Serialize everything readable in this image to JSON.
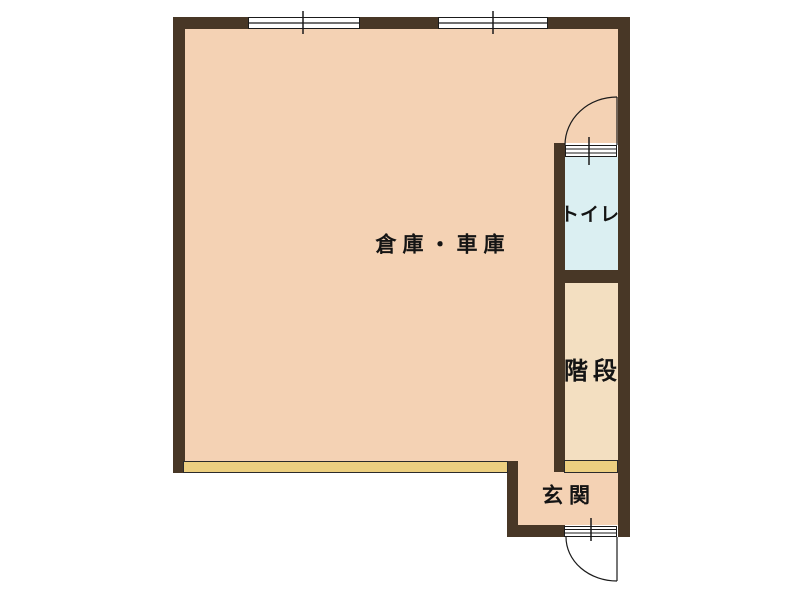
{
  "diagram": {
    "type": "floor-plan",
    "rooms": [
      {
        "name": "warehouse-garage",
        "label": "倉庫・車庫"
      },
      {
        "name": "toilet",
        "label": "トイレ"
      },
      {
        "name": "stairs",
        "label": "階段"
      },
      {
        "name": "entrance",
        "label": "玄関"
      }
    ],
    "symbols": [
      {
        "name": "sliding-window-top-left"
      },
      {
        "name": "sliding-window-top-right"
      },
      {
        "name": "toilet-door-with-swing-arc"
      },
      {
        "name": "entrance-door-with-swing-arc"
      },
      {
        "name": "garage-shutter-opening"
      },
      {
        "name": "entrance-step"
      }
    ],
    "colors": {
      "wall": "#483726",
      "room_pink": "#f4d2b4",
      "toilet_blue": "#dbeff2",
      "stairs_beige": "#f3dfc1",
      "shutter_yellow": "#eccf80",
      "line": "#1b1b1b",
      "background": "#ffffff"
    }
  }
}
